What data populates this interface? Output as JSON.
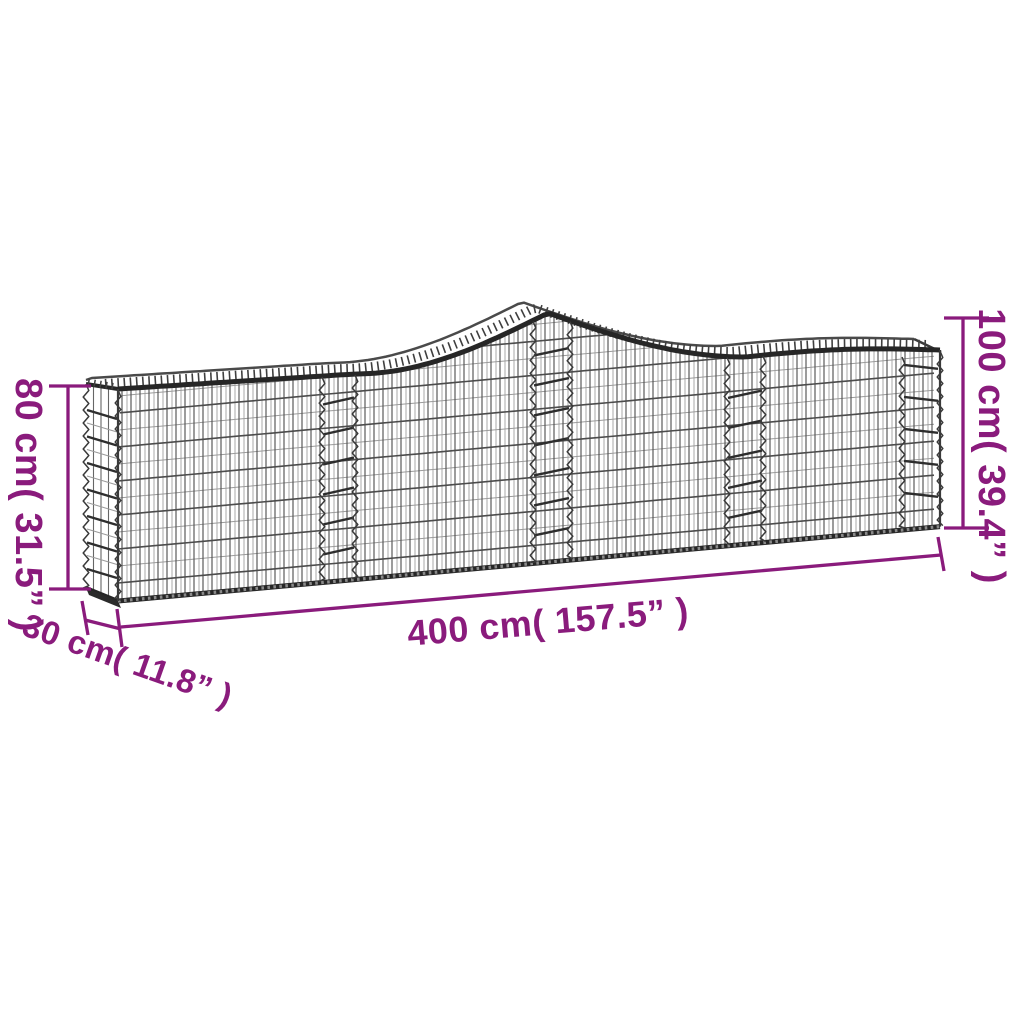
{
  "figure": {
    "kind": "product-dimension-diagram",
    "subject": "arched gabion basket, galvanised iron wire mesh",
    "background_color": "#ffffff",
    "accent_color": "#8a1b7c",
    "wire_color_dark": "#262626",
    "wire_color_mid": "#4c4c4c",
    "wire_color_light": "#9b9b9b"
  },
  "dimensions": {
    "height_left": "80 cm( 31.5” )",
    "depth": "30 cm( 11.8” )",
    "length": "400 cm( 157.5” )",
    "height_right": "100 cm( 39.4” )"
  }
}
